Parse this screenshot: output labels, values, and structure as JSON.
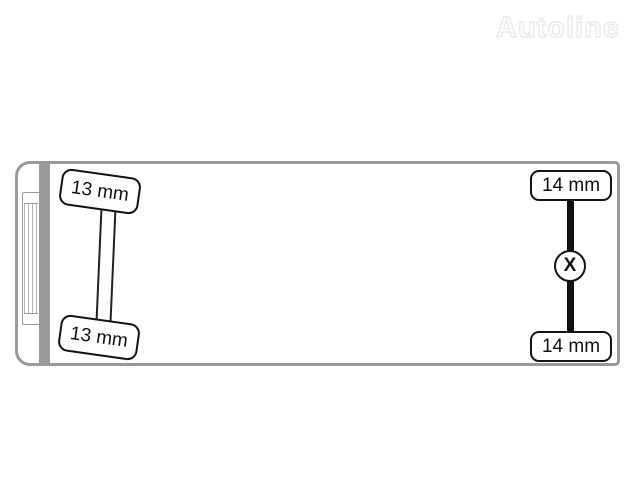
{
  "watermark": {
    "brand": "Autoline",
    "color": "#e7e7e7"
  },
  "diagram": {
    "description": "top-view truck chassis tyre tread depth scheme",
    "outline_color": "#9a9a9a",
    "line_color": "#141414",
    "front_axle": {
      "type": "steering",
      "top_wheel_label": "13 mm",
      "bottom_wheel_label": "13 mm"
    },
    "rear_axle": {
      "type": "drive",
      "marker": "X",
      "top_wheel_label": "14 mm",
      "bottom_wheel_label": "14 mm"
    }
  }
}
